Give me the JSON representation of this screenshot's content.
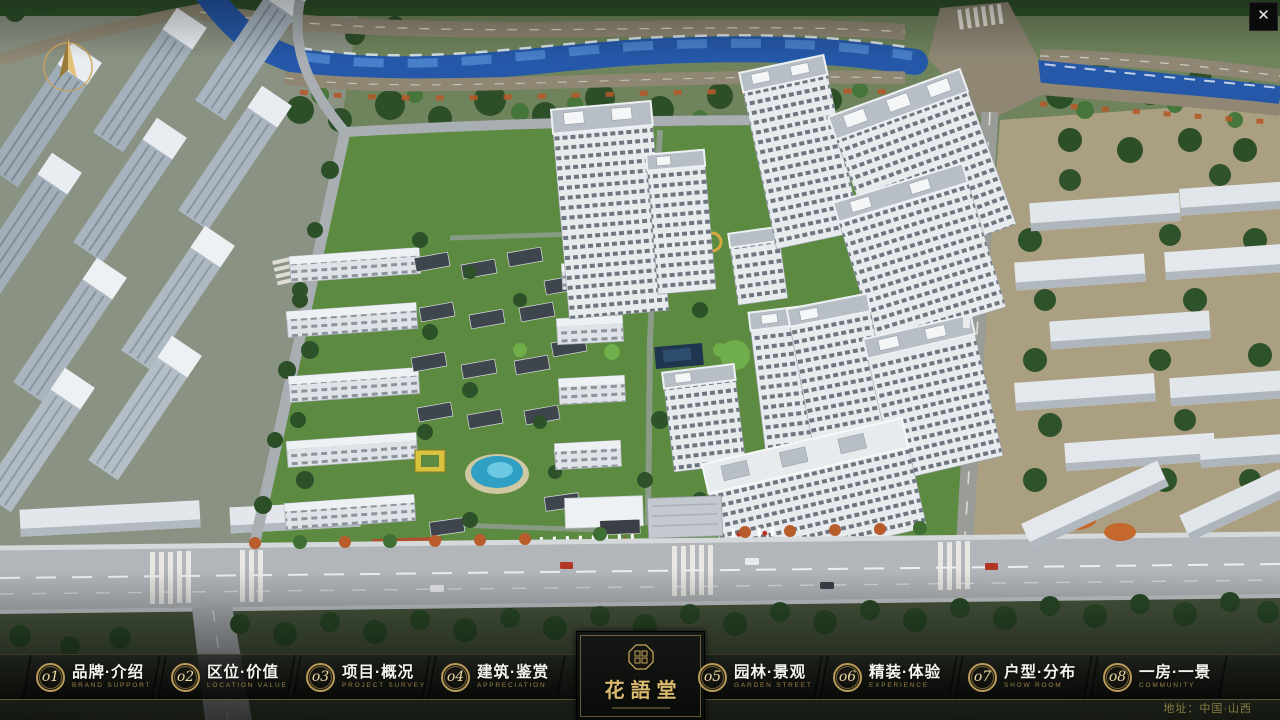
{
  "window": {
    "close_glyph": "✕"
  },
  "project": {
    "logo_title": "花語堂"
  },
  "nav": {
    "items": [
      {
        "num": "o1",
        "zh": "品牌·介绍",
        "en": "BRAND SUPPORT"
      },
      {
        "num": "o2",
        "zh": "区位·价值",
        "en": "LOCATION VALUE"
      },
      {
        "num": "o3",
        "zh": "项目·概况",
        "en": "PROJECT SURVEY"
      },
      {
        "num": "o4",
        "zh": "建筑·鉴赏",
        "en": "APPRECIATION"
      },
      {
        "num": "o5",
        "zh": "园林·景观",
        "en": "GARDEN STREET"
      },
      {
        "num": "o6",
        "zh": "精装·体验",
        "en": "EXPERIENCE"
      },
      {
        "num": "o7",
        "zh": "户型·分布",
        "en": "SHOW ROOM"
      },
      {
        "num": "o8",
        "zh": "一房·一景",
        "en": "COMMUNITY"
      }
    ]
  },
  "footer": {
    "address_label": "地址：中国·山西"
  },
  "colors": {
    "gold": "#c0a060",
    "nav_text": "#f4f4ee",
    "nav_subtext": "#9c8149",
    "bar_bg": "#0a0c0a",
    "river": "#2558a8",
    "greenery": "#5c8a40"
  }
}
